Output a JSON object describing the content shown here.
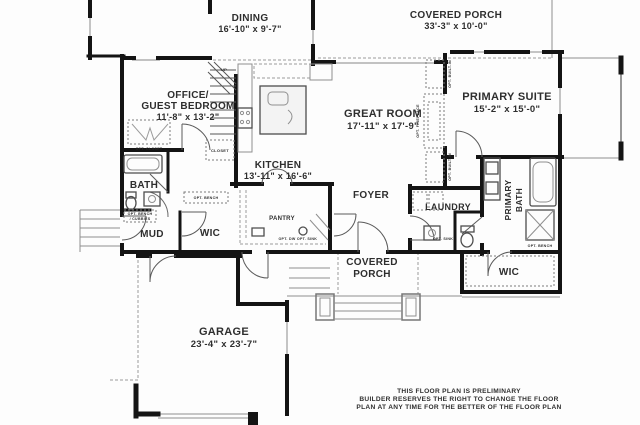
{
  "rooms": {
    "dining": {
      "name": "DINING",
      "dims": "16'-10\" x 9'-7\""
    },
    "covered_porch_top": {
      "name": "COVERED PORCH",
      "dims": "33'-3\" x 10'-0\""
    },
    "office": {
      "name_line1": "OFFICE/",
      "name_line2": "GUEST BEDROOM",
      "dims": "11'-8\" x 13'-2\""
    },
    "great_room": {
      "name": "GREAT ROOM",
      "dims": "17'-11\" x 17'-9\""
    },
    "primary_suite": {
      "name": "PRIMARY SUITE",
      "dims": "15'-2\" x 15'-0\""
    },
    "kitchen": {
      "name": "KITCHEN",
      "dims": "13'-11\" x 16'-6\""
    },
    "garage": {
      "name": "GARAGE",
      "dims": "23'-4\" x 23'-7\""
    },
    "bath": {
      "name": "BATH"
    },
    "mud": {
      "name": "MUD"
    },
    "wic_left": {
      "name": "WIC"
    },
    "wic_right": {
      "name": "WIC"
    },
    "pantry": {
      "name": "PANTRY"
    },
    "foyer": {
      "name": "FOYER"
    },
    "laundry": {
      "name": "LAUNDRY"
    },
    "primary_bath": {
      "name_line1": "PRIMARY",
      "name_line2": "BATH"
    },
    "covered_porch_bottom": {
      "name_line1": "COVERED",
      "name_line2": "PORCH"
    }
  },
  "annotations": {
    "up": "UP",
    "closet": "CLOSET",
    "opt_closet": "OPT. CLOSET",
    "opt_bench_cubbies_line1": "OPT. BENCH",
    "opt_bench_cubbies_line2": "/ CUBBIES",
    "opt_bench_wic": "OPT. BENCH",
    "opt_bench_shower": "OPT. BENCH",
    "opt_dw": "OPT. DW",
    "opt_sink_kitchen": "OPT. SINK",
    "opt_sink_laundry": "OPT. SINK",
    "opt_fireplace": "OPT. FIREPLACE",
    "opt_builtin_top": "OPT. BUILT-IN",
    "opt_builtin_bottom": "OPT. BUILT-IN"
  },
  "disclaimer": {
    "line1": "THIS FLOOR PLAN IS PRELIMINARY",
    "line2": "BUILDER RESERVES THE RIGHT TO CHANGE THE FLOOR",
    "line3": "PLAN AT ANY TIME FOR THE BETTER OF THE FLOOR PLAN"
  },
  "colors": {
    "wall": "#141414",
    "label": "#2e2e2e",
    "thin_line": "#8f8f8f",
    "background": "#fdfdfd"
  }
}
